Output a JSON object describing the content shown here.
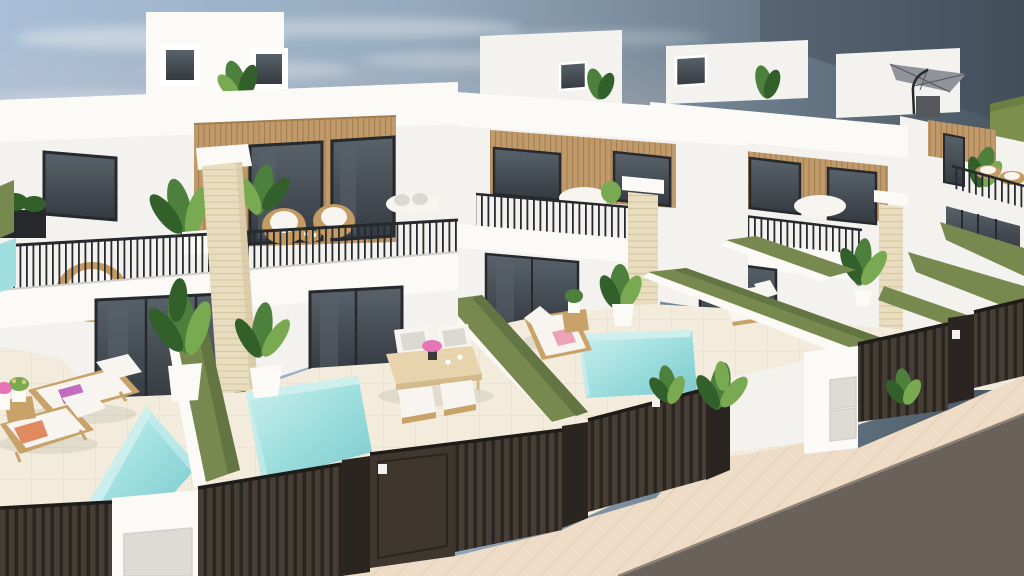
{
  "meta": {
    "title": "Row of modern white villas with private plunge pools — 3D architectural rendering"
  },
  "scene": {
    "description": "Elevated 3D architectural rendering of a terraced row of modern two-storey white villas. Each villa has a rooftop solarium box, a wood-slat facade band with floor-to-ceiling dark windows, a terrace with thin dark railing and wicker furniture, a travertine stone pillar, sliding glass doors, and a private yard with a turquoise plunge pool. Yards are separated by olive-green hedge party walls and fronted by dark slatted fences and gates with entry keypads and white utility pillars. A beige paved sidewalk and dark asphalt road run along the bottom right. The hazy sky fades from light blue on the left to slate grey on the right, with a green field on the distant right horizon. A grey cantilever parasol stands on the far roof terrace.",
    "objects": [
      "sky",
      "clouds",
      "distant green field",
      "villa rooftop solariums",
      "roof parasol",
      "wood-slat facades",
      "floor-to-ceiling windows",
      "terrace railings",
      "wicker chairs",
      "outdoor sofa",
      "travertine pillars",
      "sliding glass doors",
      "plunge pools",
      "green hedge walls",
      "sun loungers",
      "beach towels",
      "outdoor dining set",
      "potted tropical plants",
      "slatted fences",
      "entrance gates",
      "entry keypads",
      "utility pillar with meter doors",
      "paved sidewalk",
      "asphalt road"
    ]
  },
  "colors": {
    "sky_left": "#a9bfd7",
    "sky_mid": "#93a9bd",
    "sky_far": "#6e7f8e",
    "sky_right": "#475460",
    "sky_corner": "#3b4753",
    "cloud": "#dde2e8",
    "horizon_glow": "#ddccc4",
    "field": "#7d8f4c",
    "field_dark": "#6d7f42",
    "wall": "#f4f2ef",
    "wall_bright": "#fbfaf7",
    "wall_shade": "#e5e2de",
    "wall_dark": "#d3d0cc",
    "wood": "#c09a6a",
    "wood_line": "#a37e4f",
    "glass": "#343a40",
    "glass_hi": "#59626b",
    "frame": "#26292d",
    "stone": "#e9ddbf",
    "stone_line": "#d6c7a3",
    "hedge": "#78894f",
    "hedge_dark": "#647544",
    "pool_light": "#cdf0ee",
    "pool": "#9fdfdf",
    "pool_deep": "#7cc9cf",
    "patio": "#f3ecdc",
    "patio_line": "#e6d9c3",
    "fence": "#463d34",
    "fence_dark": "#2a2521",
    "fence_top": "#1f1b18",
    "sidewalk": "#eedcc6",
    "sidewalk_line": "#e0cbb1",
    "road": "#6a615a",
    "curb": "#8d8277",
    "lounge_wood": "#c9a26a",
    "cushion": "#f8f5f0",
    "cushion_shade": "#dcd8d2",
    "towel_pink": "#eca3b8",
    "towel_coral": "#e18a5f",
    "towel_magenta": "#c16cc1",
    "plant": "#4d7f3d",
    "plant_dark": "#33602a",
    "plant_light": "#79aa52",
    "wicker": "#c39b63",
    "table_wood": "#e7d4ad",
    "table_edge": "#d3ba8c",
    "umbrella": "#90939a",
    "umbrella_dark": "#54575c",
    "keypad": "#f2f1ee",
    "panel": "#dedad4",
    "flower_pink": "#e774b4",
    "flower_yellow": "#d9cf7a"
  }
}
